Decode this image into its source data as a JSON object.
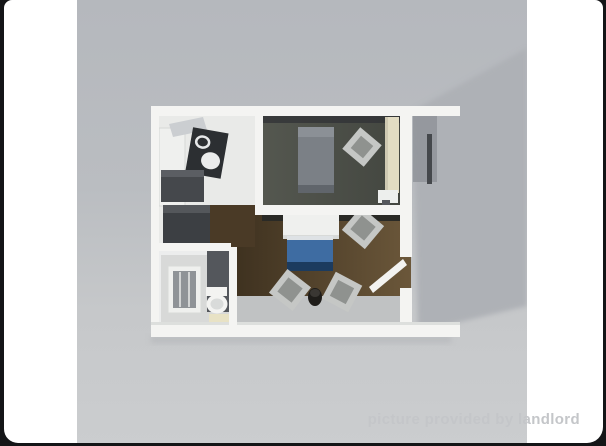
{
  "page": {
    "background_color": "#141517"
  },
  "card": {
    "background_color": "#ffffff"
  },
  "photo": {
    "description": "3D isometric rendering of a one-bedroom apartment floor plan viewed from above",
    "background_top_color": "#b5b8bd",
    "background_bottom_color": "#cbcdcf"
  },
  "floorplan": {
    "colors": {
      "shadow": "#aeb1b6",
      "wall_white": "#f4f4f2",
      "kitchen_floor": "#e9eae8",
      "bedroom_floor": "#4a4d46",
      "concrete_floor": "#c0c2c3",
      "entry_floor_brown": "#4a3a26",
      "closet_dark": "#3c3f43",
      "counter_dark": "#2c2f32",
      "refrigerator_dark": "#45484c",
      "bed_gray": "#7b8086",
      "bed_foot_gray": "#60656b",
      "sofa_top_blue": "#3e6ca2",
      "sofa_front_navy": "#1c3b5e",
      "desk_white": "#eff0ee",
      "cream_closet": "#e2dcc3",
      "bath_partition": "#54575c",
      "shower_inner": "#8f9397",
      "bath_mat": "#e8e2c5",
      "stool_dark": "#1f1d1a",
      "recess_gray": "#90949a"
    }
  },
  "watermark": {
    "text": "picture provided by landlord",
    "color": "#c4c6c9"
  }
}
